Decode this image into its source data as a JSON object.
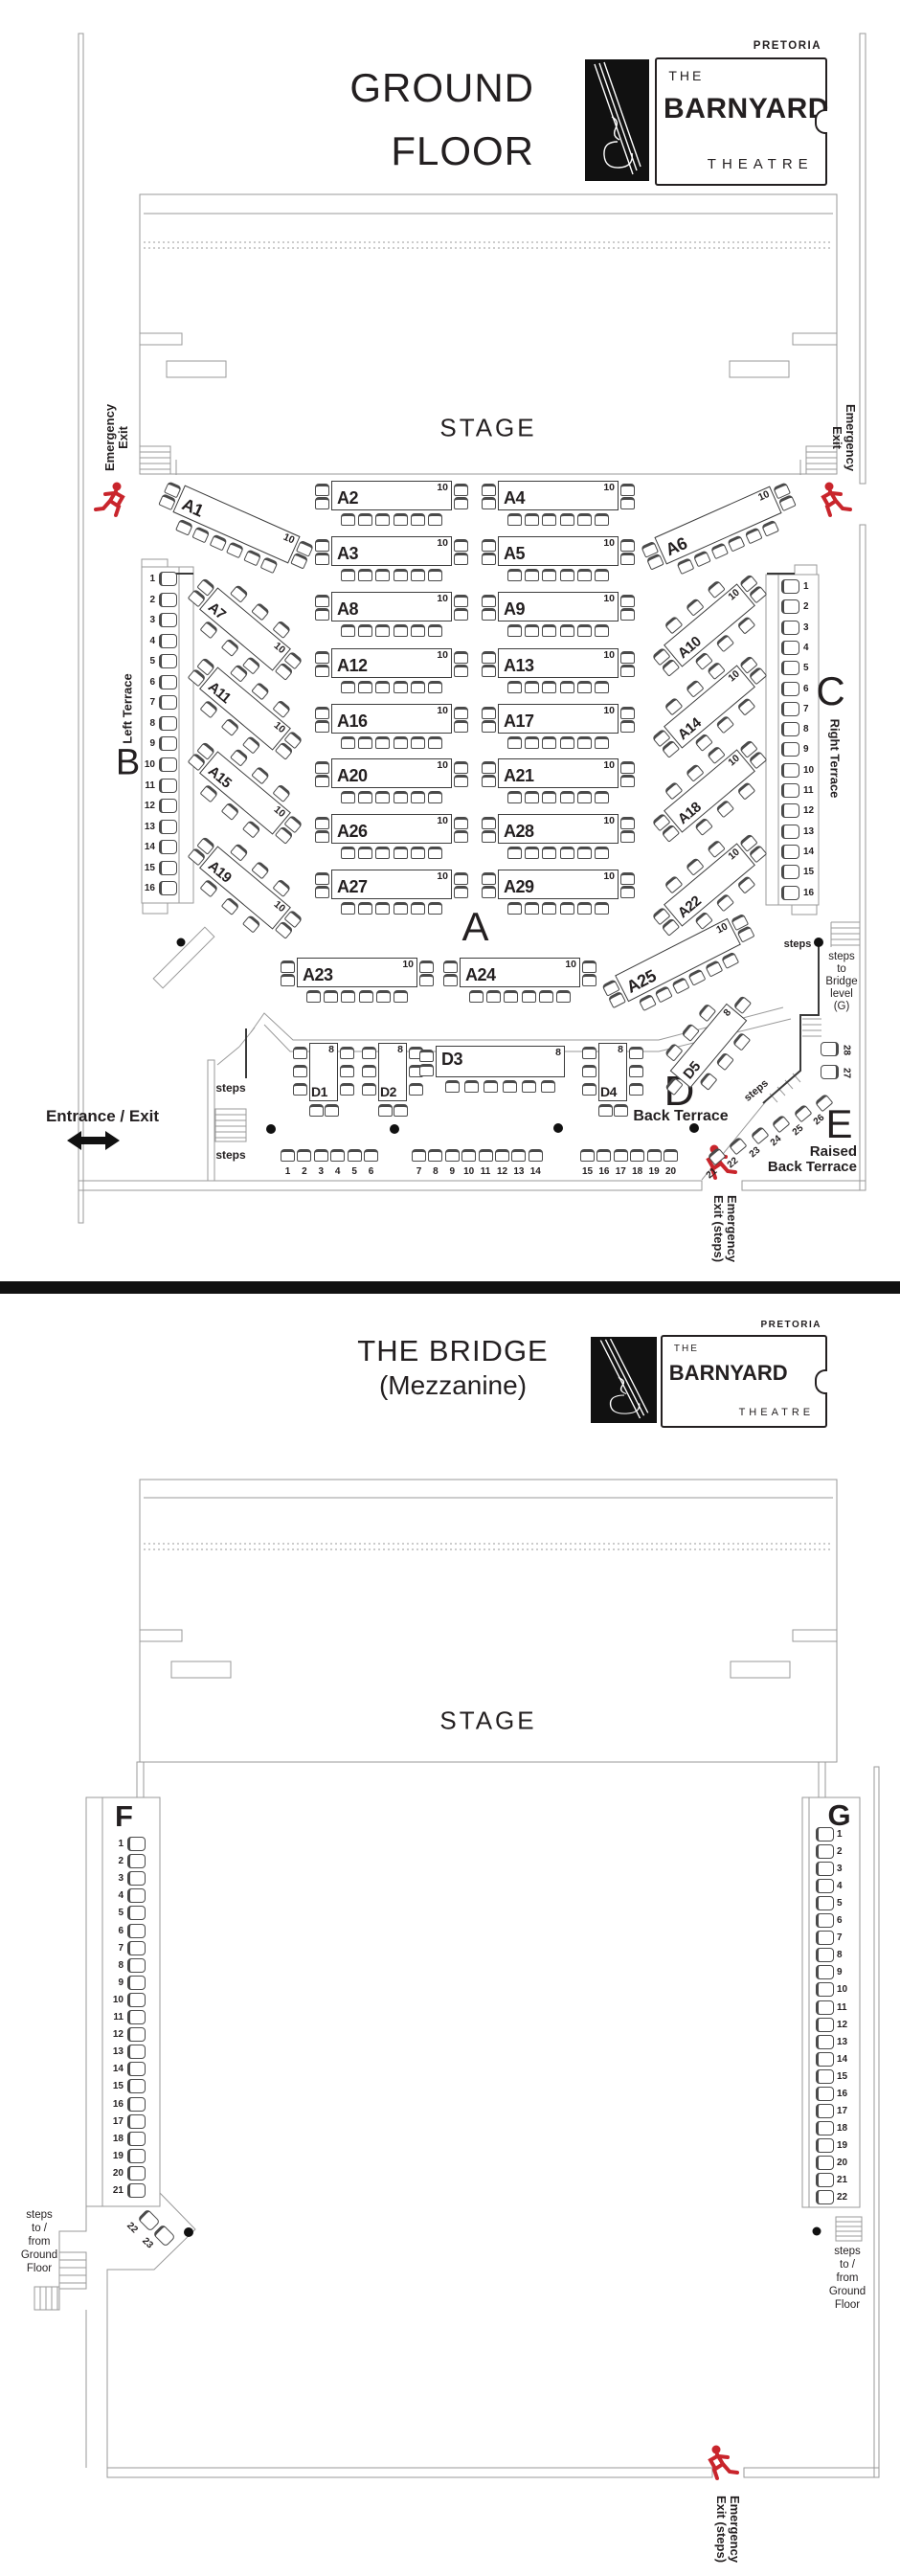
{
  "brand": {
    "city": "PRETORIA",
    "the": "THE",
    "name": "BARNYARD",
    "theatre": "THEATRE"
  },
  "ground": {
    "title1": "GROUND",
    "title2": "FLOOR",
    "stage": "STAGE",
    "sections": {
      "a": "A",
      "b": "B",
      "c": "C",
      "d": "D",
      "e": "E"
    },
    "labels": {
      "emergency_exit": "Emergency\nExit",
      "emergency_exit_steps": "Emergency\nExit (steps)",
      "entrance_exit": "Entrance / Exit",
      "left_terrace": "Left Terrace",
      "right_terrace": "Right Terrace",
      "back_terrace": "Back Terrace",
      "raised_back_terrace": "Raised\nBack Terrace",
      "steps": "steps",
      "steps_to_bridge": "steps\nto\nBridge\nlevel\n(G)"
    },
    "tables": {
      "a": [
        {
          "id": "A1",
          "cap": "10"
        },
        {
          "id": "A2",
          "cap": "10"
        },
        {
          "id": "A3",
          "cap": "10"
        },
        {
          "id": "A4",
          "cap": "10"
        },
        {
          "id": "A5",
          "cap": "10"
        },
        {
          "id": "A6",
          "cap": "10"
        },
        {
          "id": "A7",
          "cap": "10"
        },
        {
          "id": "A8",
          "cap": "10"
        },
        {
          "id": "A9",
          "cap": "10"
        },
        {
          "id": "A10",
          "cap": "10"
        },
        {
          "id": "A11",
          "cap": "10"
        },
        {
          "id": "A12",
          "cap": "10"
        },
        {
          "id": "A13",
          "cap": "10"
        },
        {
          "id": "A14",
          "cap": "10"
        },
        {
          "id": "A15",
          "cap": "10"
        },
        {
          "id": "A16",
          "cap": "10"
        },
        {
          "id": "A17",
          "cap": "10"
        },
        {
          "id": "A18",
          "cap": "10"
        },
        {
          "id": "A19",
          "cap": "10"
        },
        {
          "id": "A20",
          "cap": "10"
        },
        {
          "id": "A21",
          "cap": "10"
        },
        {
          "id": "A22",
          "cap": "10"
        },
        {
          "id": "A23",
          "cap": "10"
        },
        {
          "id": "A24",
          "cap": "10"
        },
        {
          "id": "A25",
          "cap": "10"
        },
        {
          "id": "A26",
          "cap": "10"
        },
        {
          "id": "A27",
          "cap": "10"
        },
        {
          "id": "A28",
          "cap": "10"
        },
        {
          "id": "A29",
          "cap": "10"
        }
      ],
      "d": [
        {
          "id": "D1",
          "cap": "8"
        },
        {
          "id": "D2",
          "cap": "8"
        },
        {
          "id": "D3",
          "cap": "8"
        },
        {
          "id": "D4",
          "cap": "8"
        },
        {
          "id": "D5",
          "cap": "8"
        }
      ]
    },
    "terraces": {
      "b_seats": [
        1,
        2,
        3,
        4,
        5,
        6,
        7,
        8,
        9,
        10,
        11,
        12,
        13,
        14,
        15,
        16
      ],
      "c_seats": [
        1,
        2,
        3,
        4,
        5,
        6,
        7,
        8,
        9,
        10,
        11,
        12,
        13,
        14,
        15,
        16
      ],
      "back_row": [
        [
          1,
          2,
          3,
          4,
          5,
          6
        ],
        [
          7,
          8,
          9,
          10,
          11,
          12,
          13,
          14
        ],
        [
          15,
          16,
          17,
          18,
          19,
          20
        ]
      ],
      "e_diag": [
        21,
        22,
        23,
        24,
        25,
        26
      ],
      "e_side": [
        28,
        27
      ]
    }
  },
  "bridge": {
    "title1": "THE BRIDGE",
    "title2": "(Mezzanine)",
    "stage": "STAGE",
    "sections": {
      "f": "F",
      "g": "G"
    },
    "labels": {
      "steps_to_ground": "steps\nto /\nfrom\nGround\nFloor",
      "emergency_exit_steps": "Emergency\nExit (steps)"
    },
    "terraces": {
      "f_seats": [
        1,
        2,
        3,
        4,
        5,
        6,
        7,
        8,
        9,
        10,
        11,
        12,
        13,
        14,
        15,
        16,
        17,
        18,
        19,
        20,
        21
      ],
      "f_diag": [
        22,
        23
      ],
      "g_seats": [
        1,
        2,
        3,
        4,
        5,
        6,
        7,
        8,
        9,
        10,
        11,
        12,
        13,
        14,
        15,
        16,
        17,
        18,
        19,
        20,
        21,
        22
      ]
    }
  }
}
